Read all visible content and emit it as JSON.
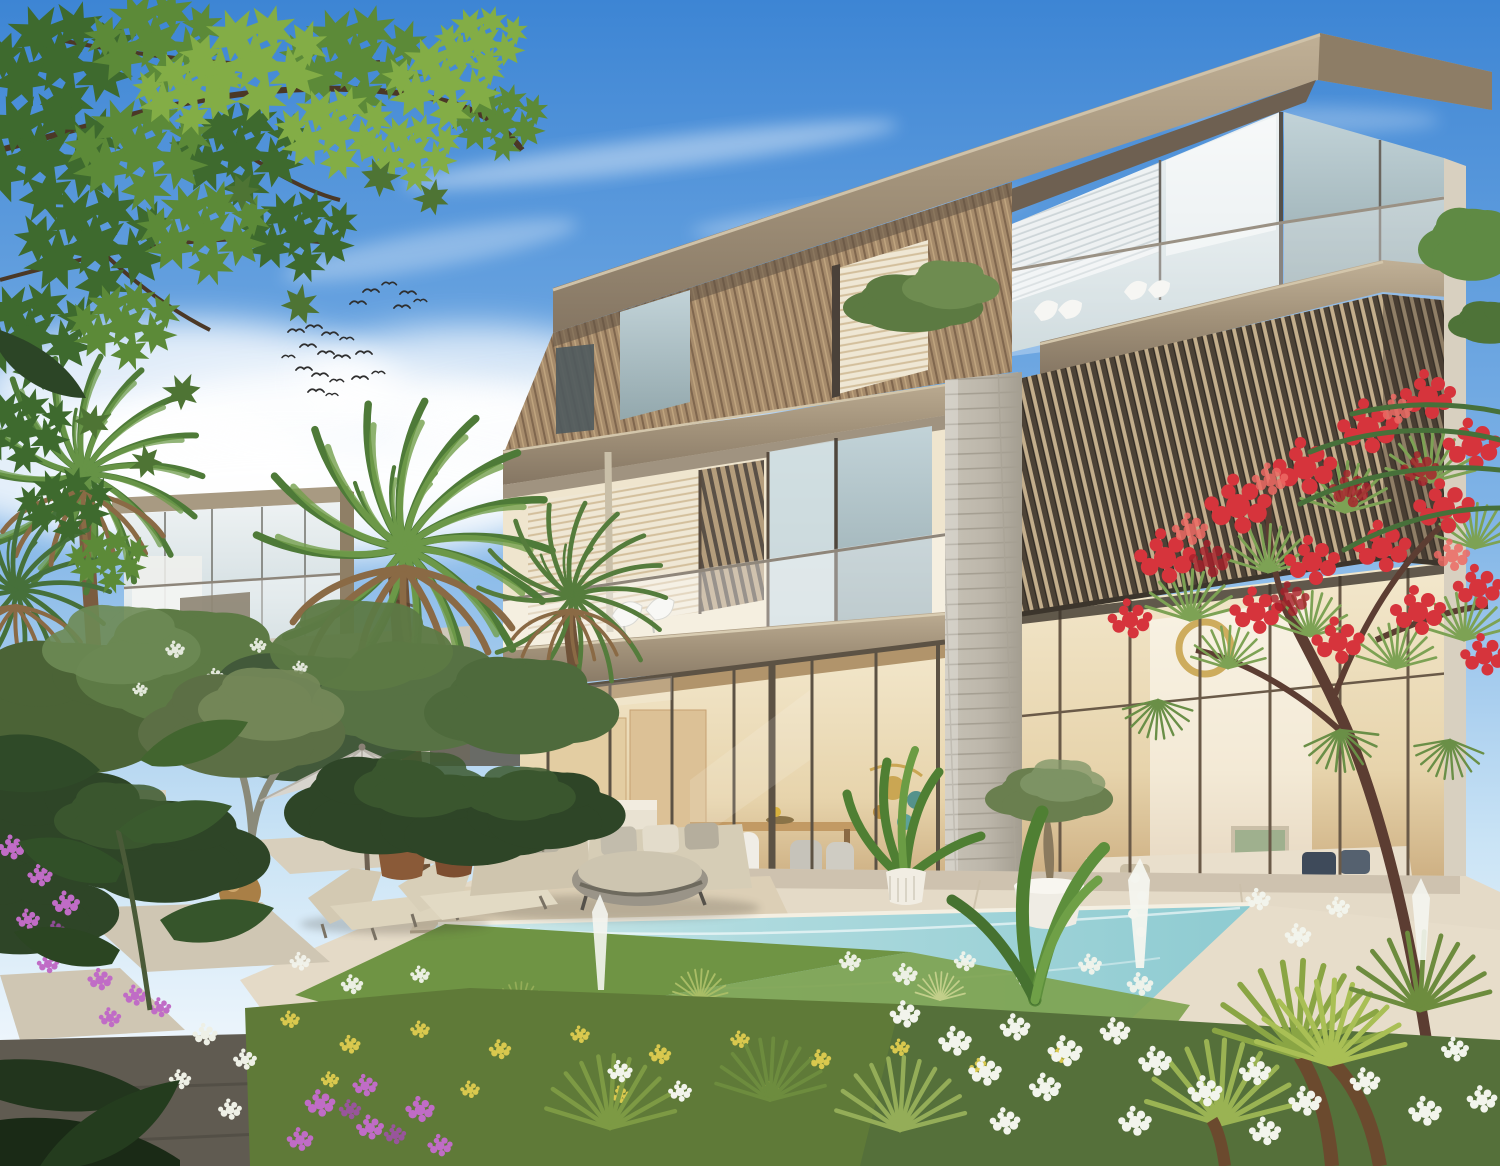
{
  "scene": {
    "type": "architectural-exterior-render",
    "subject": "modern three-storey luxury villa with pool and tropical garden",
    "time_of_day": "sunny day",
    "elements": [
      "sky",
      "clouds",
      "bird-flock",
      "maple-branch",
      "background-villa",
      "neighbor-wall",
      "palm-trees",
      "olive-trees",
      "hedge",
      "main-villa",
      "roof-overhang",
      "wood-slat-facade",
      "glass-balcony",
      "vertical-louver-screen",
      "stone-column",
      "double-height-glazing",
      "interior-living-room",
      "interior-kitchen-dining",
      "parasol",
      "sun-loungers",
      "outdoor-sofa-set",
      "clay-pots",
      "bronze-sphere-sculpture",
      "potted-olive",
      "potted-palm",
      "terrace",
      "stepping-stones",
      "swimming-pool",
      "pool-coping",
      "lawn",
      "flower-beds",
      "red-flowering-tree",
      "fan-palms",
      "foreground-foliage"
    ],
    "counts": {
      "birds": 22,
      "palm_trees": 4,
      "sun_loungers": 2,
      "balcony_chairs": 4,
      "clay_pots": 2
    }
  },
  "palette": {
    "sky_top": "#3d85d4",
    "sky_mid": "#82b5e7",
    "sky_low": "#c9e3f5",
    "sky_horizon": "#eef6fc",
    "cloud": "#ffffff",
    "roof_fascia": "#a2927a",
    "roof_light": "#cfc2a9",
    "soffit": "#6e6051",
    "wood_slat": "#a68b6b",
    "louver_dark": "#4c4236",
    "louver_glow": "#c3ae8c",
    "stone": "#bcb6aa",
    "glass_light": "#dce6e9",
    "glass_dark": "#9fb3b8",
    "interior_warm": "#e7d6b0",
    "interior_wood": "#d3b184",
    "terrace": "#e4dac7",
    "terrace_shadow": "#c7bba5",
    "pool_light": "#dff0f1",
    "pool_mid": "#aedade",
    "pool_deep": "#8ecbd1",
    "grass": "#6f9444",
    "hedge": "#2e4527",
    "olive": "#557040",
    "palm_green": "#4e7a38",
    "palm_light": "#74a04c",
    "trunk": "#7a5c40",
    "umbrella": "#d8d5ce",
    "cushion": "#d2c8b2",
    "pot_clay": "#8a5a38",
    "bronze": "#a97f46",
    "flower_red": "#d6343c",
    "flower_purple": "#c06cc6",
    "flower_white": "#f2f4ec",
    "flower_yellow": "#d9c84e",
    "path_dark": "#605b51",
    "maple_dark": "#3e6a2e",
    "maple_mid": "#5c8a38",
    "maple_light": "#83ad46",
    "bird": "#2e2e2e"
  }
}
